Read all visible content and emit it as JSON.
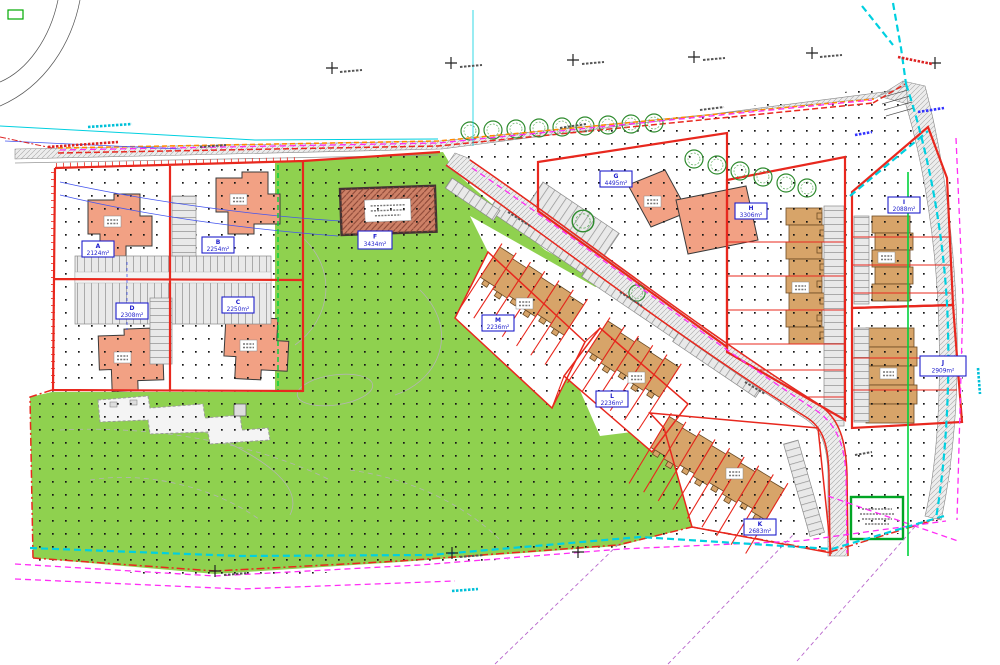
{
  "figure": {
    "type": "Residential development site layout plan",
    "canvas": {
      "width": 1000,
      "height": 665
    }
  },
  "parcels": [
    {
      "id": "A",
      "area": "2124m²"
    },
    {
      "id": "B",
      "area": "2254m²"
    },
    {
      "id": "C",
      "area": "2250m²"
    },
    {
      "id": "D",
      "area": "2308m²"
    },
    {
      "id": "F",
      "area": "3434m²"
    },
    {
      "id": "G",
      "area": "4495m²"
    },
    {
      "id": "H",
      "area": "3306m²"
    },
    {
      "id": "I",
      "area": "2088m²"
    },
    {
      "id": "J",
      "area": "2909m²"
    },
    {
      "id": "K",
      "area": "2683m²"
    },
    {
      "id": "L",
      "area": "2236m²"
    },
    {
      "id": "M",
      "area": "2236m²"
    }
  ],
  "colors": {
    "parcel_boundary_red": "#e8281e",
    "label_blue": "#2020cc",
    "open_space_green": "#8fd14f",
    "apartment_building_orange": "#f2a184",
    "terrace_building_tan": "#d7a469",
    "substation_building_brown": "#cd8066",
    "road_gray": "#ececec",
    "utility_cyan": "#00d0e0",
    "utility_magenta": "#ff2cf5",
    "utility_orange": "#ff8a00",
    "tree_green": "#2e8b2e",
    "boundary_green_dashed": "#00d23c",
    "survey_dot_black": "#111111"
  }
}
